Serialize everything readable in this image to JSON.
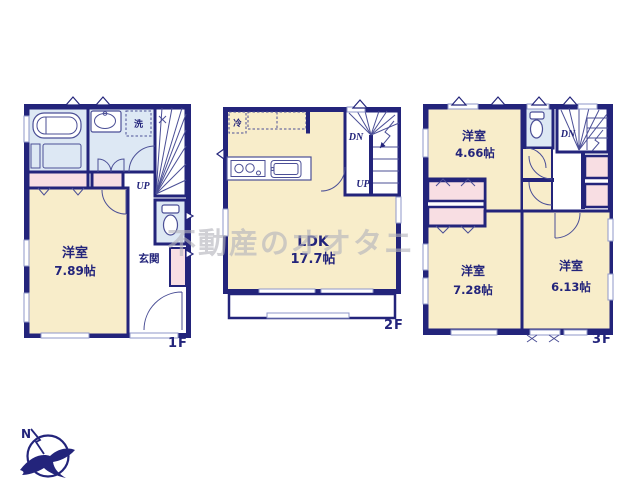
{
  "watermark": "不動産のオオタニ",
  "compass": {
    "north": "N"
  },
  "floor1": {
    "label": "1F",
    "room": {
      "name": "洋室",
      "size": "7.89帖"
    },
    "entrance": "玄関",
    "laundry": "洗",
    "up": "UP"
  },
  "floor2": {
    "label": "2F",
    "room": {
      "name": "LDK",
      "size": "17.7帖"
    },
    "fridge": "冷",
    "down": "DN",
    "up": "UP"
  },
  "floor3": {
    "label": "3F",
    "room_a": {
      "name": "洋室",
      "size": "4.66帖"
    },
    "room_b": {
      "name": "洋室",
      "size": "7.28帖"
    },
    "room_c": {
      "name": "洋室",
      "size": "6.13帖"
    },
    "down": "DN"
  },
  "colors": {
    "wall": "#23247b",
    "room": "#f8edca",
    "wet": "#dde8f4",
    "closet": "#f8dee3"
  }
}
